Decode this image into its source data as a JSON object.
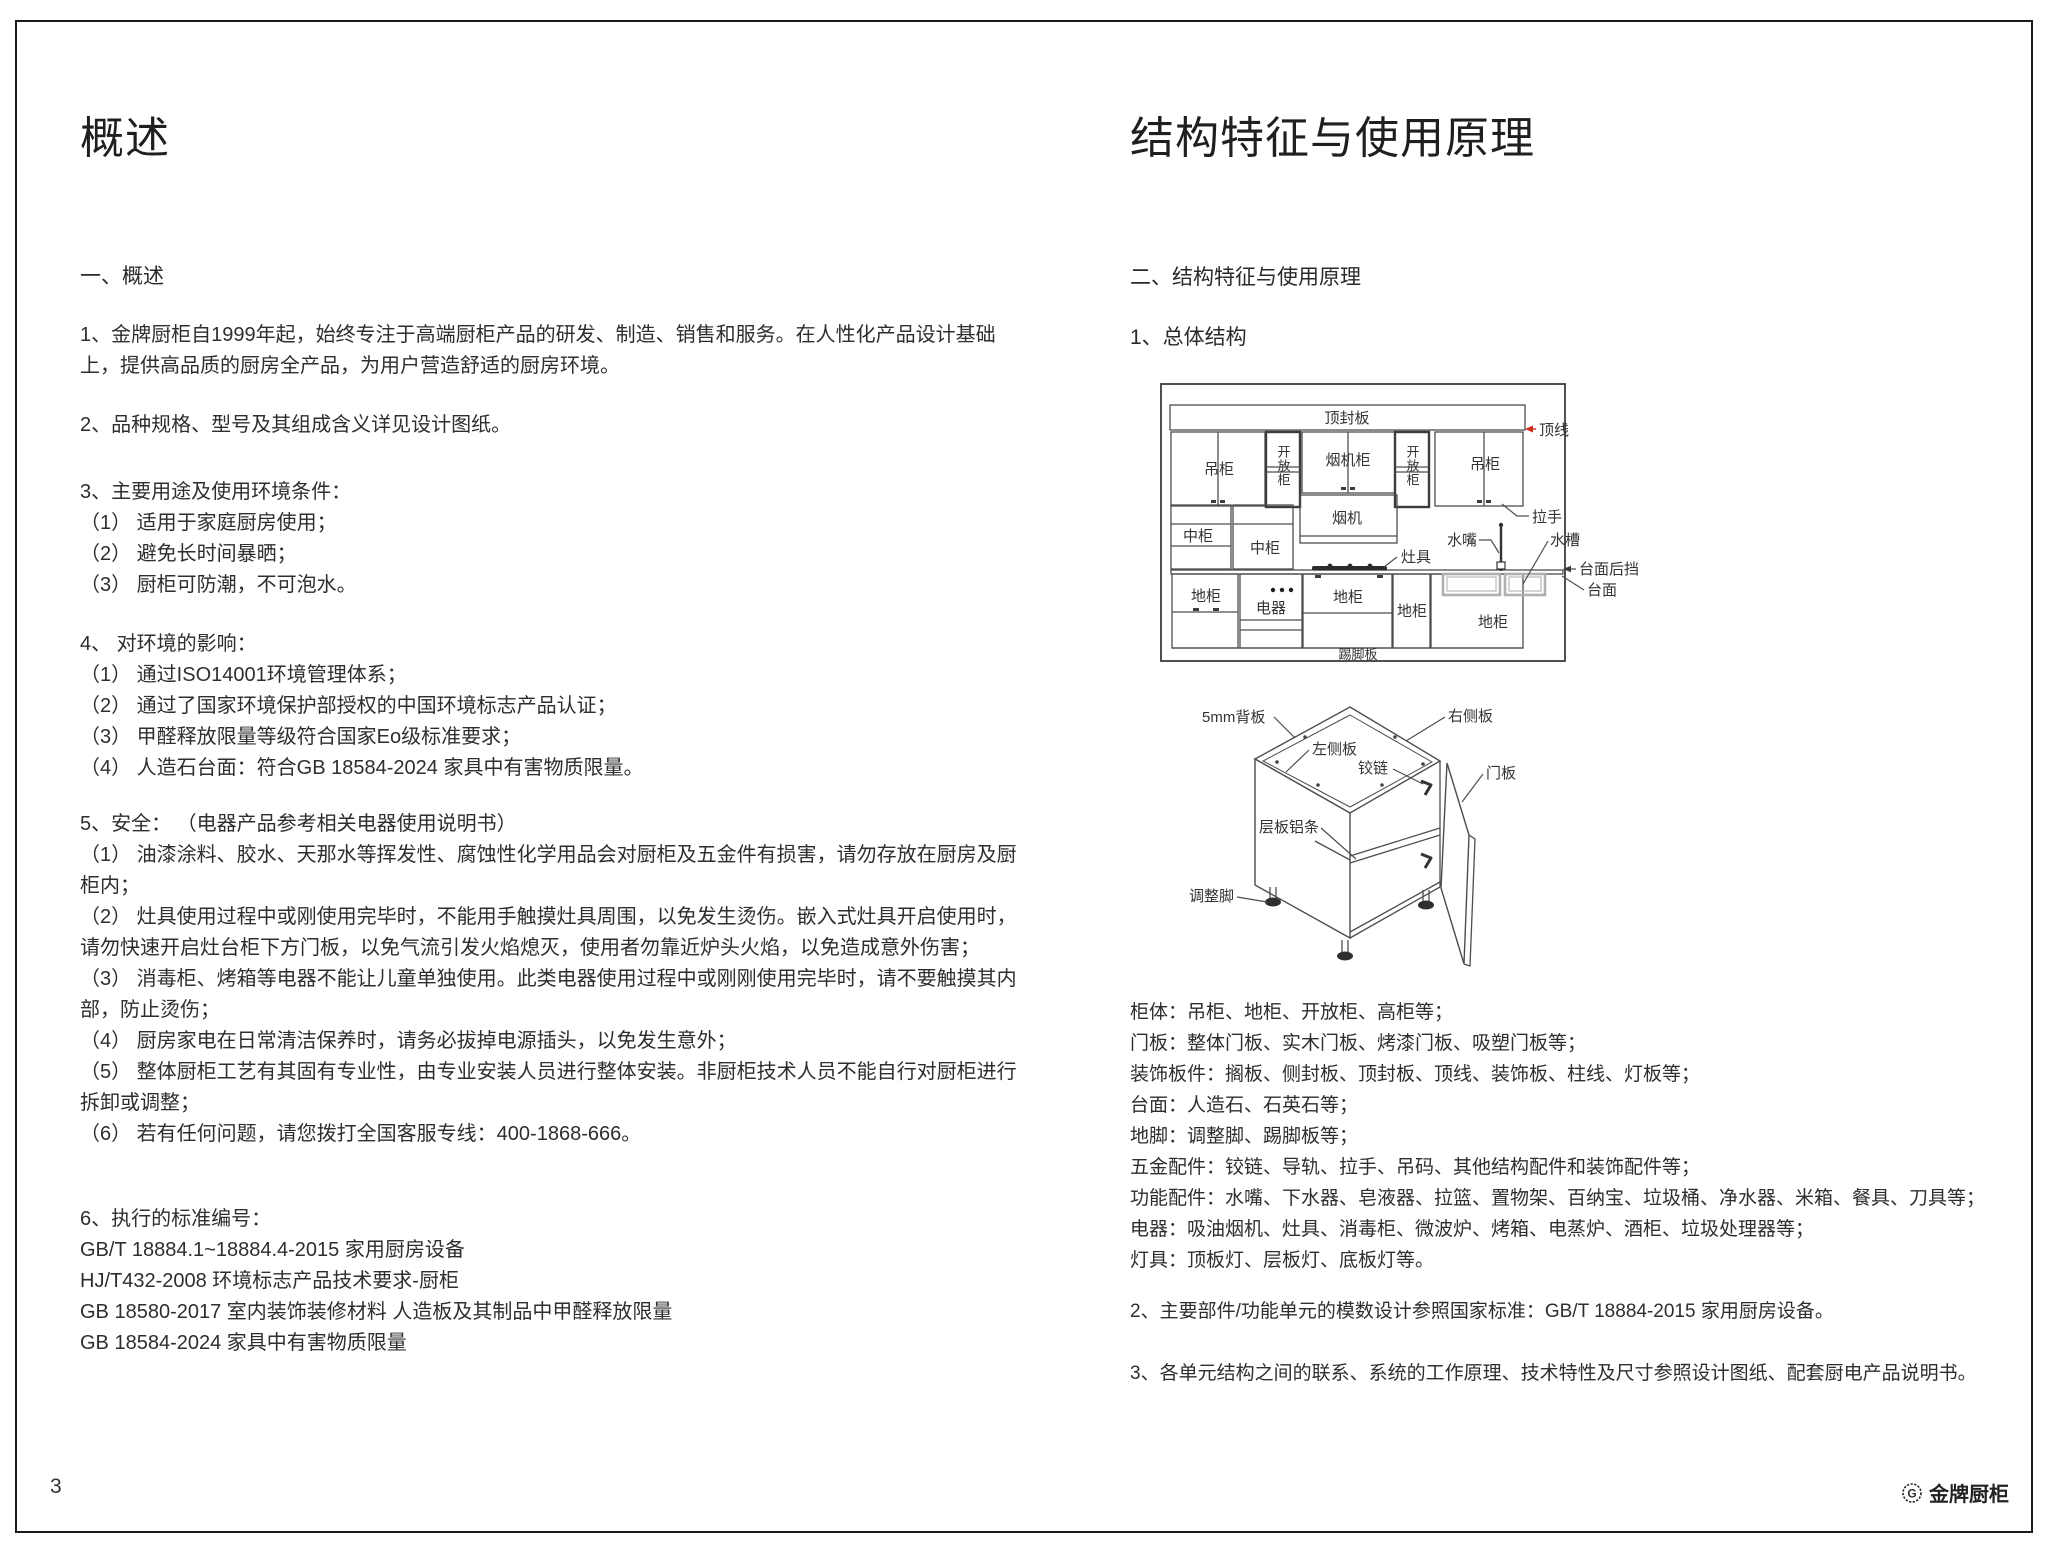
{
  "page": {
    "number": "3",
    "brand_name": "金牌厨柜",
    "brand_icon": "G"
  },
  "colors": {
    "topline_red": "#d02a1e",
    "sink_gray": "#b0b0b0"
  },
  "left": {
    "title": "概述",
    "heading": "一、概述",
    "p1": "1、金牌厨柜自1999年起，始终专注于高端厨柜产品的研发、制造、销售和服务。在人性化产品设计基础上，提供高品质的厨房全产品，为用户营造舒适的厨房环境。",
    "p2": "2、品种规格、型号及其组成含义详见设计图纸。",
    "s3_head": "3、主要用途及使用环境条件：",
    "s3_1": "（1） 适用于家庭厨房使用；",
    "s3_2": "（2） 避免长时间暴晒；",
    "s3_3": "（3） 厨柜可防潮，不可泡水。",
    "s4_head": "4、 对环境的影响：",
    "s4_1": "（1） 通过ISO14001环境管理体系；",
    "s4_2": "（2） 通过了国家环境保护部授权的中国环境标志产品认证；",
    "s4_3": "（3） 甲醛释放限量等级符合国家Eo级标准要求；",
    "s4_4": "（4） 人造石台面：符合GB 18584-2024 家具中有害物质限量。",
    "s5_head": "5、安全： （电器产品参考相关电器使用说明书）",
    "s5_1": "（1） 油漆涂料、胶水、天那水等挥发性、腐蚀性化学用品会对厨柜及五金件有损害，请勿存放在厨房及厨柜内；",
    "s5_2": "（2） 灶具使用过程中或刚使用完毕时，不能用手触摸灶具周围，以免发生烫伤。嵌入式灶具开启使用时，请勿快速开启灶台柜下方门板，以免气流引发火焰熄灭，使用者勿靠近炉头火焰，以免造成意外伤害；",
    "s5_3": "（3） 消毒柜、烤箱等电器不能让儿童单独使用。此类电器使用过程中或刚刚使用完毕时，请不要触摸其内部，防止烫伤；",
    "s5_4": "（4） 厨房家电在日常清洁保养时，请务必拔掉电源插头，以免发生意外；",
    "s5_5": "（5） 整体厨柜工艺有其固有专业性，由专业安装人员进行整体安装。非厨柜技术人员不能自行对厨柜进行拆卸或调整；",
    "s5_6": "（6） 若有任何问题，请您拨打全国客服专线：400-1868-666。",
    "s6_head": "6、执行的标准编号：",
    "s6_1": "GB/T 18884.1~18884.4-2015 家用厨房设备",
    "s6_2": "HJ/T432-2008 环境标志产品技术要求-厨柜",
    "s6_3": "GB 18580-2017 室内装饰装修材料 人造板及其制品中甲醛释放限量",
    "s6_4": "GB 18584-2024 家具中有害物质限量"
  },
  "right": {
    "title": "结构特征与使用原理",
    "heading": "二、结构特征与使用原理",
    "sub1": "1、总体结构",
    "list": [
      "柜体：吊柜、地柜、开放柜、高柜等；",
      "门板：整体门板、实木门板、烤漆门板、吸塑门板等；",
      "装饰板件：搁板、侧封板、顶封板、顶线、装饰板、柱线、灯板等；",
      "台面：人造石、石英石等；",
      "地脚：调整脚、踢脚板等；",
      "五金配件：铰链、导轨、拉手、吊码、其他结构配件和装饰配件等；",
      "功能配件：水嘴、下水器、皂液器、拉篮、置物架、百纳宝、垃圾桶、净水器、米箱、餐具、刀具等；",
      "电器：吸油烟机、灶具、消毒柜、微波炉、烤箱、电蒸炉、酒柜、垃圾处理器等；",
      "灯具：顶板灯、层板灯、底板灯等。"
    ],
    "p2": "2、主要部件/功能单元的模数设计参照国家标准：GB/T 18884-2015 家用厨房设备。",
    "p3": "3、各单元结构之间的联系、系统的工作原理、技术特性及尺寸参照设计图纸、配套厨电产品说明书。"
  },
  "d1": {
    "top_board": "顶封板",
    "top_line": "顶线",
    "wall_cabinet": "吊柜",
    "open_cabinet": "开放柜",
    "hood_cabinet": "烟机柜",
    "handle": "拉手",
    "mid_cabinet": "中柜",
    "hood": "烟机",
    "cooktop": "灶具",
    "faucet": "水嘴",
    "sink": "水槽",
    "backsplash": "台面后挡",
    "countertop": "台面",
    "base_cabinet": "地柜",
    "appliance": "电器",
    "kickboard": "踢脚板"
  },
  "d2": {
    "back_panel": "5mm背板",
    "right_panel": "右侧板",
    "left_panel": "左侧板",
    "hinge": "铰链",
    "door_panel": "门板",
    "shelf_strip": "层板铝条",
    "foot": "调整脚"
  }
}
